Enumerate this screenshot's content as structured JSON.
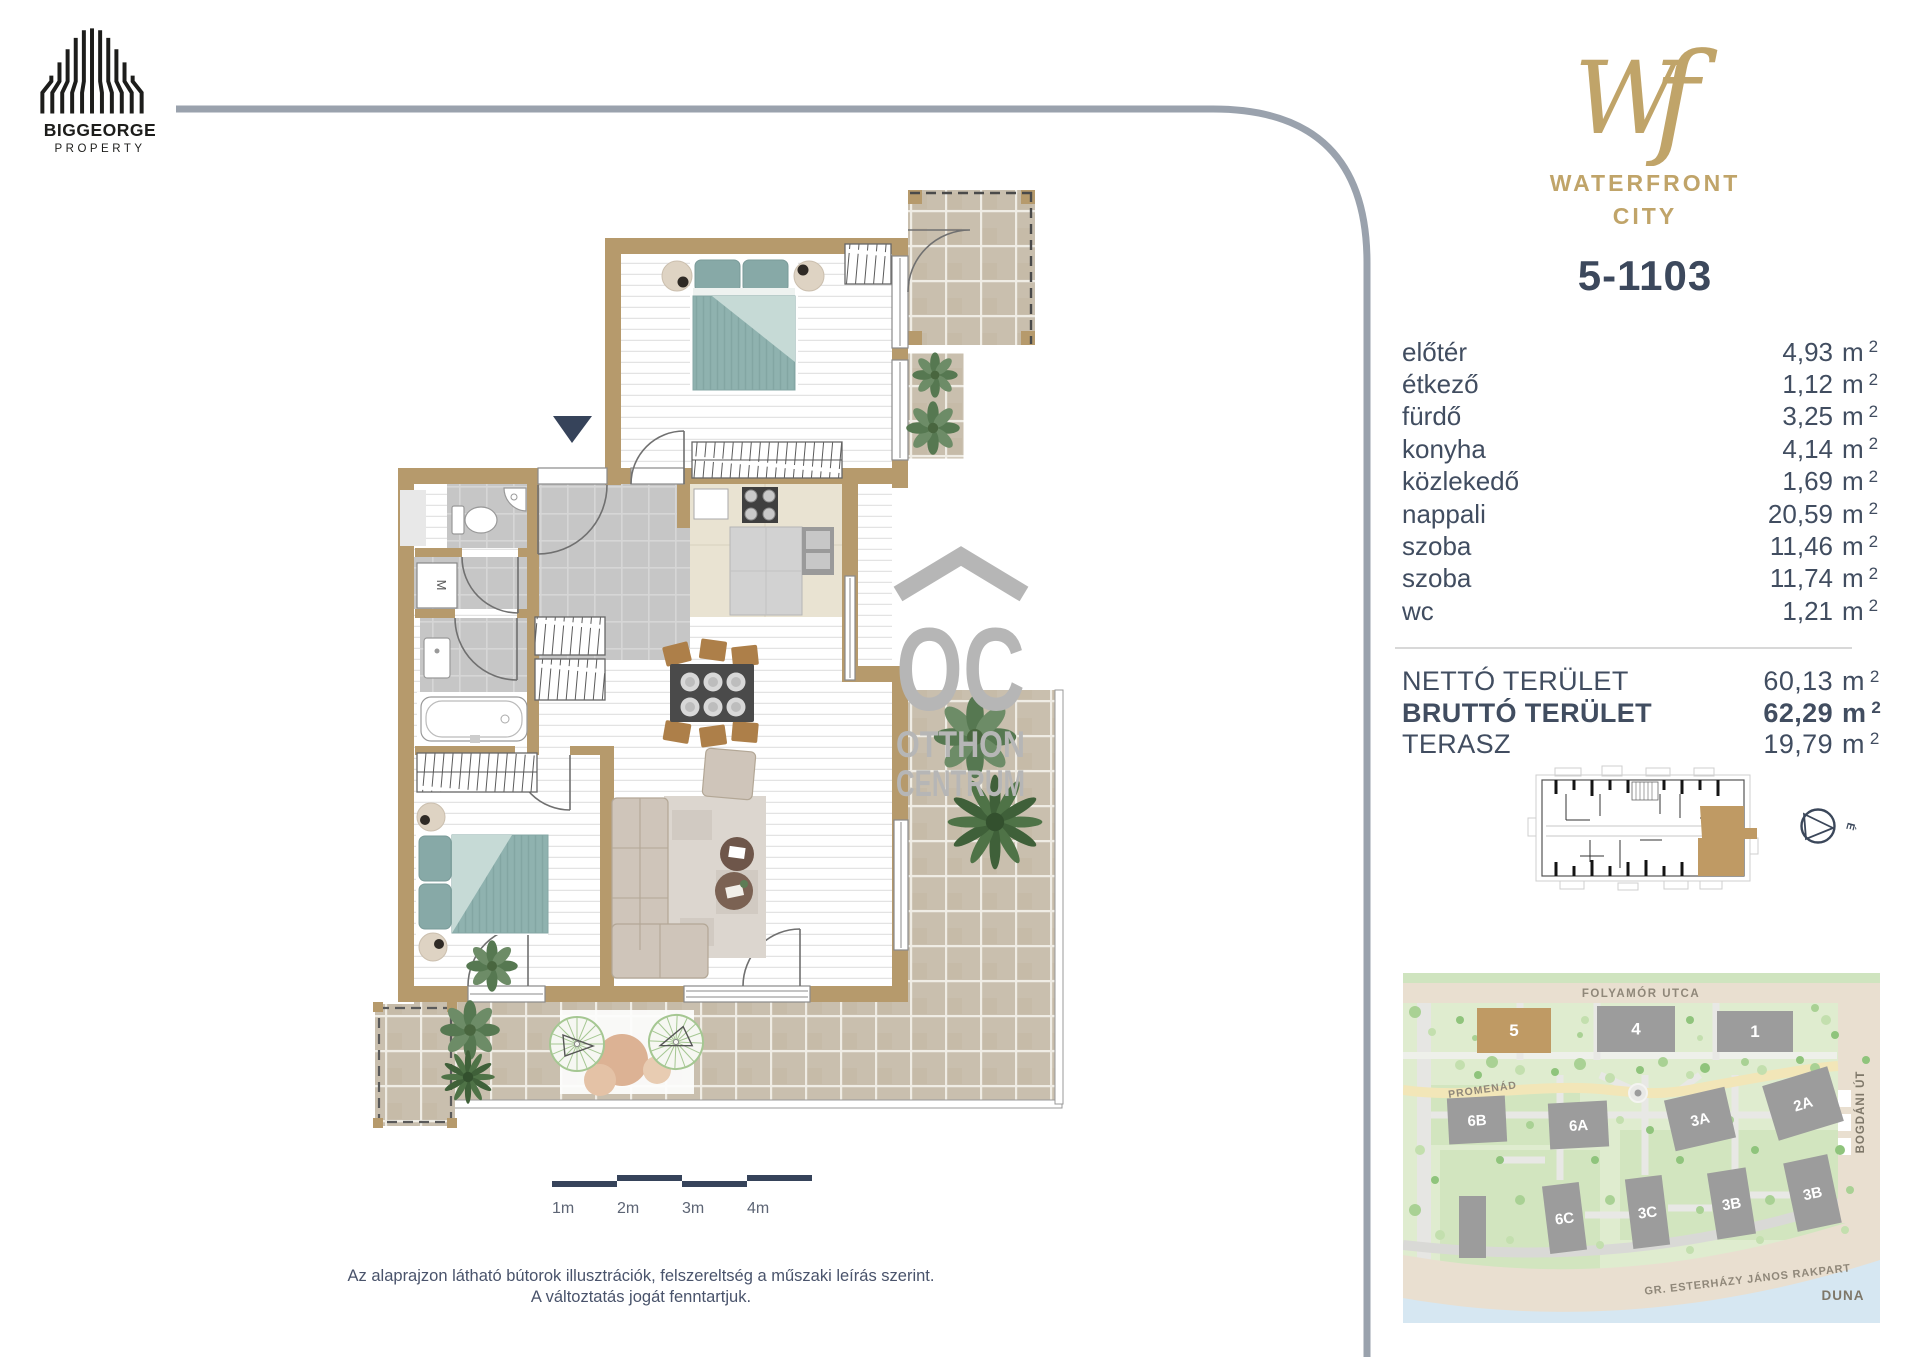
{
  "branding": {
    "developer_name": "BIGGEORGE",
    "developer_subtitle": "PROPERTY",
    "project_monogram": "Wf",
    "project_name_line1": "WATERFRONT",
    "project_name_line2": "CITY",
    "watermark_abbr": "OC",
    "watermark_line1": "OTTHON",
    "watermark_line2": "CENTRUM"
  },
  "unit": {
    "id": "5-1103"
  },
  "areas": {
    "unit_symbol": "m",
    "unit_sup": "2",
    "rooms": [
      {
        "label": "előtér",
        "value": "4,93"
      },
      {
        "label": "étkező",
        "value": "1,12"
      },
      {
        "label": "fürdő",
        "value": "3,25"
      },
      {
        "label": "konyha",
        "value": "4,14"
      },
      {
        "label": "közlekedő",
        "value": "1,69"
      },
      {
        "label": "nappali",
        "value": "20,59"
      },
      {
        "label": "szoba",
        "value": "11,46"
      },
      {
        "label": "szoba",
        "value": "11,74"
      },
      {
        "label": "wc",
        "value": "1,21"
      }
    ],
    "totals": [
      {
        "label": "NETTÓ TERÜLET",
        "value": "60,13",
        "bold": false
      },
      {
        "label": "BRUTTÓ TERÜLET",
        "value": "62,29",
        "bold": true
      },
      {
        "label": "TERASZ",
        "value": "19,79",
        "bold": false
      }
    ]
  },
  "compass": {
    "north_label": "É"
  },
  "scale_bar": {
    "labels": [
      "1m",
      "2m",
      "3m",
      "4m"
    ]
  },
  "floor_plan": {
    "washing_machine_label": "M"
  },
  "site_map": {
    "streets": {
      "top": "FOLYAMÓR UTCA",
      "promenade": "PROMENÁD",
      "right": "BOGDÁNI ÚT",
      "embankment": "GR. ESTERHÁZY JÁNOS RAKPART",
      "river": "DUNA"
    },
    "buildings": [
      {
        "label": "5",
        "highlighted": true
      },
      {
        "label": "4",
        "highlighted": false
      },
      {
        "label": "1",
        "highlighted": false
      },
      {
        "label": "6B",
        "highlighted": false
      },
      {
        "label": "6A",
        "highlighted": false
      },
      {
        "label": "3A",
        "highlighted": false
      },
      {
        "label": "2A",
        "highlighted": false
      },
      {
        "label": "",
        "highlighted": false
      },
      {
        "label": "6C",
        "highlighted": false
      },
      {
        "label": "3C",
        "highlighted": false
      },
      {
        "label": "3B",
        "highlighted": false
      },
      {
        "label": "3B",
        "highlighted": false
      }
    ]
  },
  "disclaimer": {
    "line1": "Az alaprajzon látható bútorok illusztrációk, felszereltség a műszaki leírás szerint.",
    "line2": "A változtatás jogát fenntartjuk."
  },
  "colors": {
    "accent_gold": "#c0a469",
    "navy": "#3c485c",
    "wall_tan": "#b69a6c",
    "unit_highlight": "#bf9a64",
    "watermark_gray": "#b6b6b6"
  }
}
